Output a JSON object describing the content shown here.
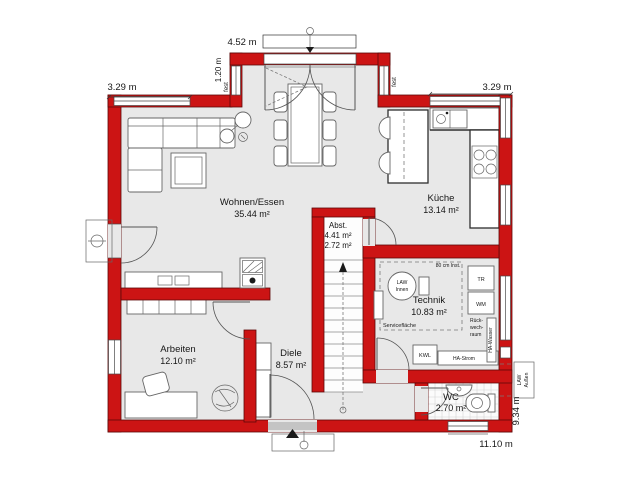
{
  "plan": {
    "rooms": [
      {
        "name": "Wohnen/Essen",
        "area": "35.44 m²"
      },
      {
        "name": "Küche",
        "area": "13.14 m²"
      },
      {
        "name": "Abst.",
        "area": "4.41 m²",
        "area2": "2.72 m²"
      },
      {
        "name": "Technik",
        "area": "10.83 m²"
      },
      {
        "name": "Arbeiten",
        "area": "12.10 m²"
      },
      {
        "name": "Diele",
        "area": "8.57 m²"
      },
      {
        "name": "WC",
        "area": "2.70 m²"
      }
    ],
    "dimensions": {
      "top_left": "3.29 m",
      "top_center": "4.52 m",
      "top_right": "3.29 m",
      "bay_depth": "1.20 m",
      "bottom": "11.10 m",
      "right": "9.34 m",
      "fixed_left": "fest",
      "fixed_right": "fest"
    },
    "technik": {
      "law_line1": "LAW",
      "law_line2": "Innen",
      "inst": "80 cm Inst.",
      "tr": "TR",
      "wm": "WM",
      "kwl": "KWL",
      "back1": "Rück-",
      "back2": "wech-",
      "back3": "raum",
      "service": "Servicefläche",
      "ha_strom": "HA-Strom",
      "ha_wasser": "HA-Wasser",
      "law_out1": "LAW",
      "law_out2": "Außen"
    },
    "colors": {
      "wall": "#cc1414",
      "floor": "#e8e8e8"
    }
  }
}
